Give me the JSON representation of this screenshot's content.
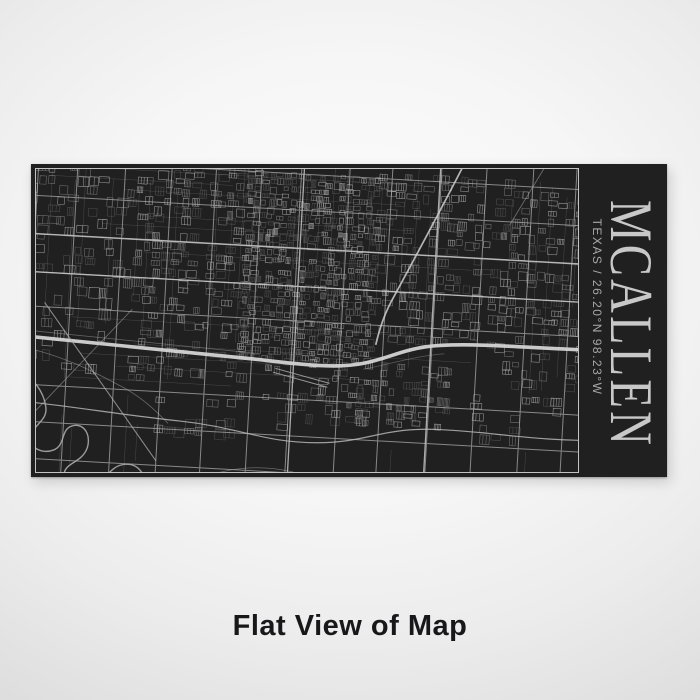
{
  "product": {
    "panel_color": "#202021",
    "frame_color": "#c3c3c3",
    "engraving": {
      "city": "MCALLEN",
      "location_line": "Texas / 26.20°N 98.23°W",
      "title_color": "#c8c8c8",
      "subtitle_color": "#a8a8a8",
      "map_background": "#202021",
      "map_line_color": "#b5b5b5",
      "map_highlight_color": "#d4d4d4",
      "map_rotation_deg": 3.2
    }
  },
  "caption": {
    "text": "Flat View of Map",
    "color": "#18181a"
  },
  "background": {
    "center": "#fdfdfd",
    "edge": "#dcdcdc"
  }
}
